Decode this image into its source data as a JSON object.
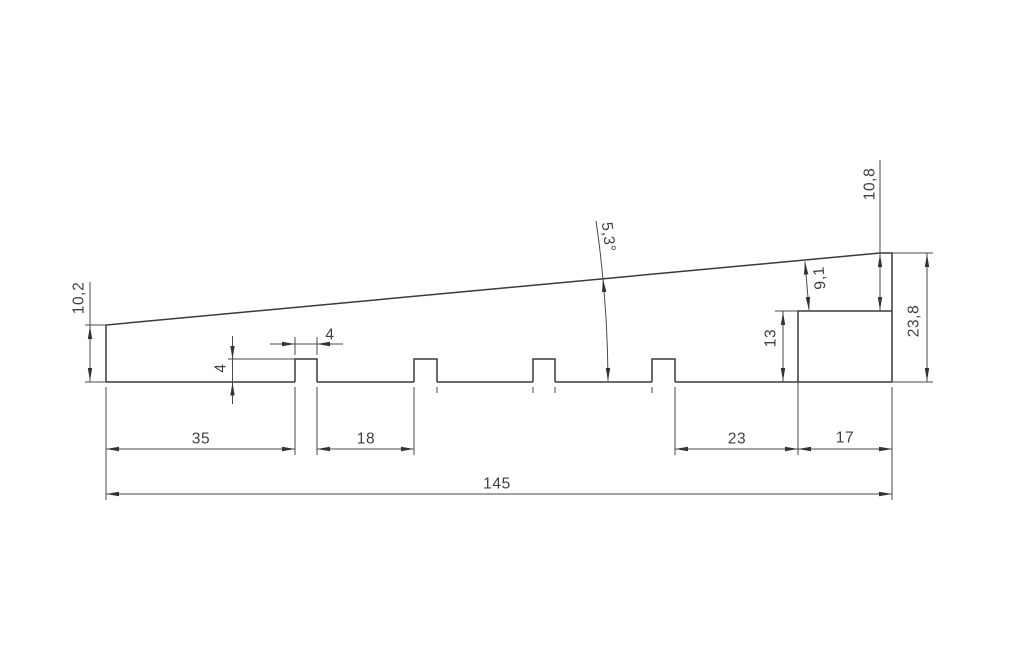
{
  "drawing": {
    "type": "technical-drawing",
    "line_color": "#3a3a3a",
    "background_color": "#ffffff",
    "dimensions": {
      "left_height": "10,2",
      "slot_depth": "4",
      "slot_width": "4",
      "segment_first": "35",
      "segment_between_slots": "18",
      "segment_before_step": "23",
      "segment_step": "17",
      "overall_length": "145",
      "step_height": "13",
      "perpendicular_to_slope": "9,1",
      "right_upper_height": "10,8",
      "right_total_height": "23,8",
      "slope_angle": "5,3°"
    }
  }
}
